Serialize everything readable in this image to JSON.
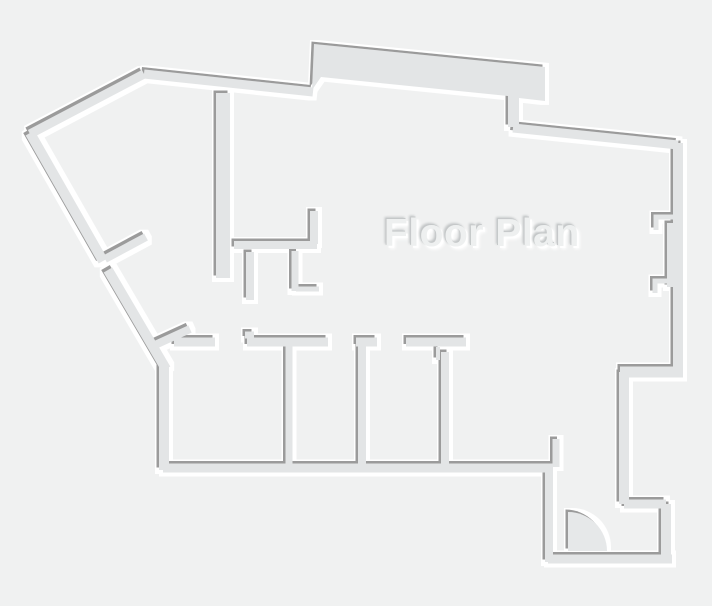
{
  "floor_plan": {
    "canvas": {
      "width": 712,
      "height": 606
    },
    "colors": {
      "background": "#f0f1f1",
      "wall": "#e3e5e6",
      "shadow": "#9b9b9b",
      "highlight": "#ffffff",
      "door": "#e6e8e9",
      "title": "#eef0f0",
      "title_edge": "#c5c8c9"
    },
    "title": {
      "text": "Floor Plan",
      "x": 384,
      "y": 212,
      "font_size": 39
    },
    "polygons": [
      {
        "name": "roof-slab",
        "points": [
          [
            314,
            44
          ],
          [
            545,
            67
          ],
          [
            545,
            101
          ],
          [
            519,
            98
          ],
          [
            519,
            127
          ],
          [
            508,
            127
          ],
          [
            508,
            96
          ],
          [
            321,
            77
          ],
          [
            312,
            90
          ]
        ]
      }
    ],
    "walls": [
      {
        "name": "outer-nw-diagonal",
        "points": [
          [
            30,
            134
          ],
          [
            144,
            74
          ]
        ],
        "width": 9
      },
      {
        "name": "outer-n-left",
        "points": [
          [
            144,
            74
          ],
          [
            313,
            92
          ]
        ],
        "width": 9
      },
      {
        "name": "outer-n-right",
        "points": [
          [
            513,
            128
          ],
          [
            678,
            145
          ]
        ],
        "width": 9
      },
      {
        "name": "outer-e-upper",
        "points": [
          [
            678,
            143
          ],
          [
            678,
            372
          ]
        ],
        "width": 10
      },
      {
        "name": "outer-e-step",
        "points": [
          [
            683,
            372
          ],
          [
            620,
            372
          ]
        ],
        "width": 11
      },
      {
        "name": "outer-e-mid",
        "points": [
          [
            624,
            372
          ],
          [
            624,
            504
          ]
        ],
        "width": 10
      },
      {
        "name": "outer-se-step",
        "points": [
          [
            624,
            504
          ],
          [
            666,
            504
          ]
        ],
        "width": 9
      },
      {
        "name": "outer-se-side",
        "points": [
          [
            666,
            504
          ],
          [
            666,
            559
          ]
        ],
        "width": 10
      },
      {
        "name": "outer-s-entry",
        "points": [
          [
            672,
            559
          ],
          [
            548,
            559
          ]
        ],
        "width": 9
      },
      {
        "name": "entry-west-wall",
        "points": [
          [
            549,
            562
          ],
          [
            549,
            466
          ]
        ],
        "width": 8
      },
      {
        "name": "outer-s-rooms",
        "points": [
          [
            553,
            468
          ],
          [
            163,
            468
          ]
        ],
        "width": 9
      },
      {
        "name": "outer-w-lower",
        "points": [
          [
            164,
            470
          ],
          [
            164,
            365
          ]
        ],
        "width": 10
      },
      {
        "name": "outer-sw-diagonal-lower",
        "points": [
          [
            108,
            270
          ],
          [
            166,
            369
          ]
        ],
        "width": 10
      },
      {
        "name": "outer-sw-diagonal-upper",
        "points": [
          [
            30,
            133
          ],
          [
            103,
            261
          ]
        ],
        "width": 10
      },
      {
        "name": "hall-wall",
        "points": [
          [
            223,
            93
          ],
          [
            223,
            278
          ]
        ],
        "width": 14
      },
      {
        "name": "closet-south-wall",
        "points": [
          [
            234,
            245
          ],
          [
            317,
            245
          ]
        ],
        "width": 8
      },
      {
        "name": "closet-stub-left",
        "points": [
          [
            250,
            252
          ],
          [
            250,
            300
          ]
        ],
        "width": 8
      },
      {
        "name": "closet-stub-right",
        "points": [
          [
            295,
            251
          ],
          [
            295,
            291
          ]
        ],
        "width": 7
      },
      {
        "name": "closet-stub-bottom",
        "points": [
          [
            296,
            289
          ],
          [
            319,
            289
          ]
        ],
        "width": 5
      },
      {
        "name": "closet-north-stub",
        "points": [
          [
            314,
            211
          ],
          [
            314,
            244
          ]
        ],
        "width": 8
      },
      {
        "name": "diagonal-door-leaf",
        "points": [
          [
            105,
            259
          ],
          [
            146,
            237
          ]
        ],
        "width": 8
      },
      {
        "name": "corner-chamfer-stub",
        "points": [
          [
            155,
            345
          ],
          [
            190,
            329
          ]
        ],
        "width": 8
      },
      {
        "name": "rooms-north-wall-1",
        "points": [
          [
            174,
            342
          ],
          [
            215,
            342
          ]
        ],
        "width": 9
      },
      {
        "name": "rooms-north-wall-2",
        "points": [
          [
            247,
            342
          ],
          [
            328,
            342
          ]
        ],
        "width": 9
      },
      {
        "name": "rooms-north-wall-2-notch",
        "points": [
          [
            245,
            335
          ],
          [
            254,
            335
          ]
        ],
        "width": 7
      },
      {
        "name": "rooms-north-wall-3",
        "points": [
          [
            356,
            342
          ],
          [
            377,
            342
          ]
        ],
        "width": 9
      },
      {
        "name": "partition-west",
        "points": [
          [
            362,
            340
          ],
          [
            362,
            464
          ]
        ],
        "width": 8
      },
      {
        "name": "rooms-north-wall-4",
        "points": [
          [
            406,
            342
          ],
          [
            466,
            342
          ]
        ],
        "width": 9
      },
      {
        "name": "partition-east-stub",
        "points": [
          [
            438,
            347
          ],
          [
            438,
            360
          ]
        ],
        "width": 4
      },
      {
        "name": "partition-east",
        "points": [
          [
            445,
            352
          ],
          [
            445,
            464
          ]
        ],
        "width": 8
      },
      {
        "name": "partition-mid",
        "points": [
          [
            289,
            346
          ],
          [
            289,
            464
          ]
        ],
        "width": 7
      },
      {
        "name": "entry-door-jamb",
        "points": [
          [
            556,
            439
          ],
          [
            556,
            467
          ]
        ],
        "width": 7
      },
      {
        "name": "right-door-jamb-upper",
        "points": [
          [
            678,
            217
          ],
          [
            656,
            217
          ],
          [
            656,
            230
          ]
        ],
        "width": 5
      },
      {
        "name": "right-door-jamb-lower",
        "points": [
          [
            678,
            281
          ],
          [
            655,
            281
          ],
          [
            655,
            293
          ]
        ],
        "width": 5
      },
      {
        "name": "right-door-leaf",
        "points": [
          [
            671,
            223
          ],
          [
            671,
            287
          ]
        ],
        "width": 8
      }
    ],
    "doors": [
      {
        "name": "entry-door-swing",
        "cx": 568,
        "cy": 551,
        "r": 39
      }
    ]
  }
}
